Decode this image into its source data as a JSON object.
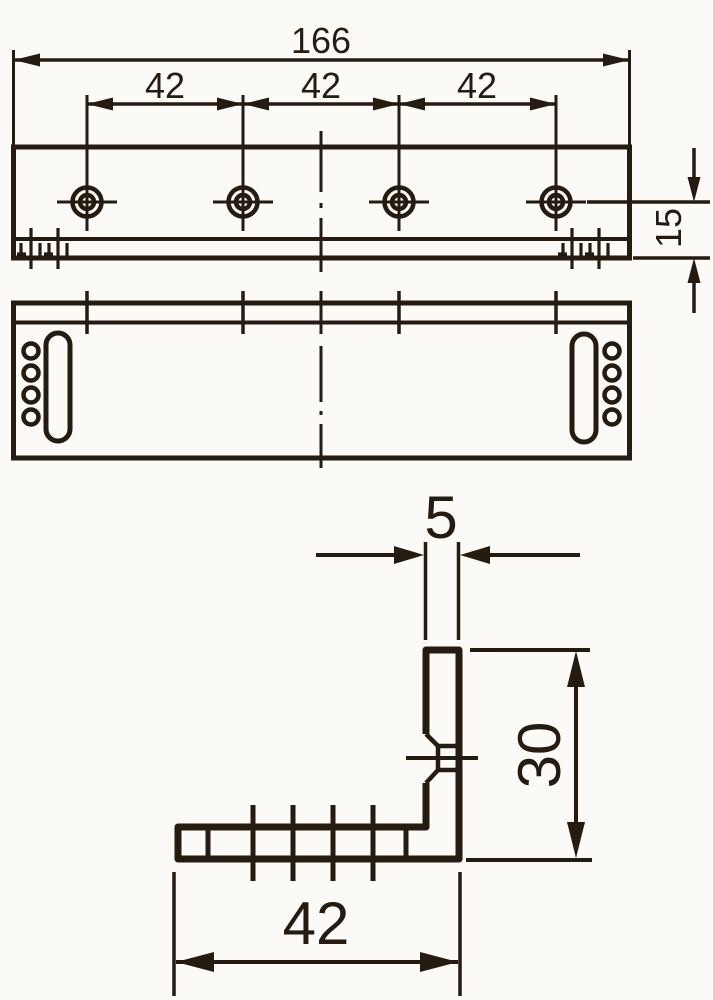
{
  "drawing": {
    "type": "technical-drawing",
    "part": "L-shaped mounting bracket, three orthographic views",
    "colors": {
      "ink": "#251b11",
      "paper": "#fbfaf7"
    },
    "views": {
      "top_view": {
        "holes": 4,
        "dims_shown": [
          "166",
          "42",
          "42",
          "42",
          "15"
        ]
      },
      "front_view": {
        "slots": 2,
        "side_holes": 8
      },
      "section_view": {
        "dims_shown": [
          "5",
          "30",
          "42"
        ]
      }
    },
    "dims": {
      "overall": "166",
      "pitch1": "42",
      "pitch2": "42",
      "pitch3": "42",
      "edge": "15",
      "thickness": "5",
      "leg": "30",
      "base": "42"
    }
  }
}
